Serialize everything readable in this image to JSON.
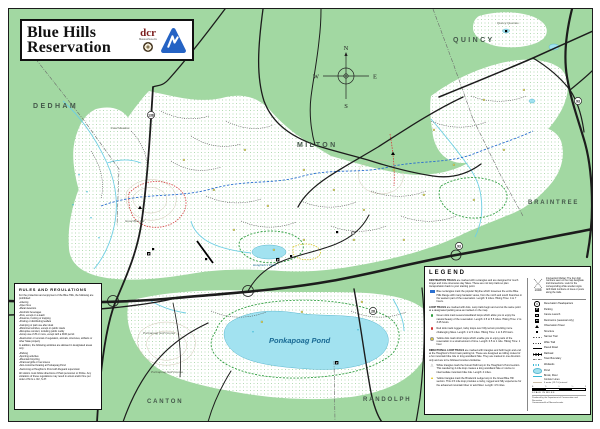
{
  "title_block": {
    "line1": "Blue Hills",
    "line2": "Reservation",
    "dcr": "dcr",
    "dcr_sub": "Massachusetts"
  },
  "compass": {
    "n": "N",
    "e": "E",
    "s": "S",
    "w": "W"
  },
  "map_labels": {
    "towns": [
      {
        "name": "DEDHAM"
      },
      {
        "name": "MILTON"
      },
      {
        "name": "QUINCY"
      },
      {
        "name": "BRAINTREE"
      },
      {
        "name": "CANTON"
      },
      {
        "name": "RANDOLPH"
      }
    ],
    "features": [
      {
        "name": "Fowl Meadow"
      },
      {
        "name": "Great Blue Hill"
      },
      {
        "name": "Houghton's Pond"
      },
      {
        "name": "Ponkapoag Pond"
      },
      {
        "name": "Ponkapoag Golf Course"
      },
      {
        "name": "Quincy Quarries"
      }
    ],
    "route_shields": [
      "128",
      "138",
      "93",
      "28",
      "93"
    ],
    "parking_glyph": "P"
  },
  "rules": {
    "title": "RULES AND REGULATIONS",
    "intro": "For the protection and enjoyment of the Blue Hills, the following are prohibited:",
    "prohibited": [
      "Littering",
      "Open fires",
      "Metal detectors",
      "Alcoholic beverages",
      "Pets, except on a leash",
      "Firearms, hunting or trapping",
      "Posting or distributing leaflets",
      "Camping or park use after dusk",
      "Motorized vehicles, except on public roads",
      "Disruptive conduct, including public nudity",
      "Group use of 25 or more, except with a DCR permit",
      "Destruction or removal of vegetation, animals, structures, artifacts or other State property"
    ],
    "allowed_intro": "In addition, the following activities are allowed in designated areas only:",
    "allowed": [
      "Parking",
      "Sporting activities",
      "Mountain bicycling",
      "Charcoal grills or fuel stoves",
      "Non-motorized boating at Ponkapoag Pond",
      "Swimming at Houghton's Pond with lifeguard supervision"
    ],
    "footer": "All visitors must follow directions of Park personnel or Police. Any violations of these regulations may result in arrest and/or fine per order of M.G.L. R2, S.37."
  },
  "legend": {
    "title": "LEGEND",
    "destination_head": "DESTINATION TRAILS",
    "destination_rest": " are marked with rectangles and are designed for much longer and more strenuous day hikes. These are not loop trails so plan transportation back to your starting point.",
    "skyline": "Blue rectangles mark the popular Skyline which traverses the entire Blue Hills Range with many fantastic views, from the north and south branches in the western part of the reservation. Length: 9 miles. Hiking Time: 4 to 7 hours.",
    "loop_head": "LOOP TRAILS",
    "loop_rest": " are marked with dots. Loop trails begin and end at the same point at a designated parking area as marked on the map.",
    "green_loop": "Green dots mark several woodland loops which allow you to enjoy the natural beauty of the reservation. Length: 2.5 to 5.5 miles. Hiking Time: 2 to 3.25 hours.",
    "red_loop": "Red dots mark rugged, rocky loops over hilly terrain providing more challenging hikes. Length: 1 to 5 miles. Hiking Time: 1 to 3.25 hours.",
    "yellow_loop": "Yellow dots mark short loops which enable you to enjoy parts of the reservation in a small amount of time. Length: 0.5 to 1 mile. Hiking Time: 1 hour.",
    "directional_head": "DIRECTIONAL LOOP TRAILS",
    "directional_rest": " are marked with triangles and both begin and end at the Houghton's Pond main parking lot. These are designed as rolling routes for a fun mountain bike ride or long woodland hike. They are marked in one direction only and are to be followed counter-clockwise.",
    "white_triangle": "White triangles mark the Forest Path loop in the Houghton's Pond section. This wandering 4-mile loop creates a long woodland hike or novice to intermediate mountain bike ride. Length: 4 miles.",
    "yellow_triangle": "Yellow triangles mark the Broderick Ledge loop in the Great Blue Hill section. This 4.5 mile loop provides a rocky, rugged and hilly experience for the advanced mountain biker or avid hiker. Length: 4.5 miles.",
    "intersection_note": "Intersection Marker: The four digit numbers seen on the map designate trail intersections. Look for the corresponding white wooden signs with black numbers on trees or posts along the trails.",
    "intersection_example": "1085",
    "symbols": [
      {
        "label": "Reservation Headquarters"
      },
      {
        "label": "Parking"
      },
      {
        "label": "Canoe Launch"
      },
      {
        "label": "Restrooms (seasonal only)"
      },
      {
        "label": "Observation Tower"
      },
      {
        "label": "Structure"
      },
      {
        "label": "Narrow Trail"
      },
      {
        "label": "Wide Trail"
      },
      {
        "label": "Paved Road"
      },
      {
        "label": "Railroad"
      },
      {
        "label": "Town Boundary"
      },
      {
        "label": "Wetlands"
      },
      {
        "label": "Pond"
      },
      {
        "label": "Brook, River"
      },
      {
        "label": "Contour Lines",
        "sub": "6 meter (19.7 ft) interval"
      }
    ],
    "scale": {
      "ticks": [
        "0",
        "¼",
        "½",
        "¾",
        "1"
      ],
      "caption": "SCALE IN MILES"
    },
    "credits": [
      "Produced by the Department of Conservation and Recreation",
      "Commonwealth of Massachusetts"
    ]
  },
  "colors": {
    "town_green": "#a2d8a2",
    "water_blue": "#a2e2f0",
    "skyline_blue": "#2a6fd0",
    "loop_green": "#2f9e3f",
    "loop_red": "#d42f2f",
    "loop_yellow": "#e8d02a"
  }
}
